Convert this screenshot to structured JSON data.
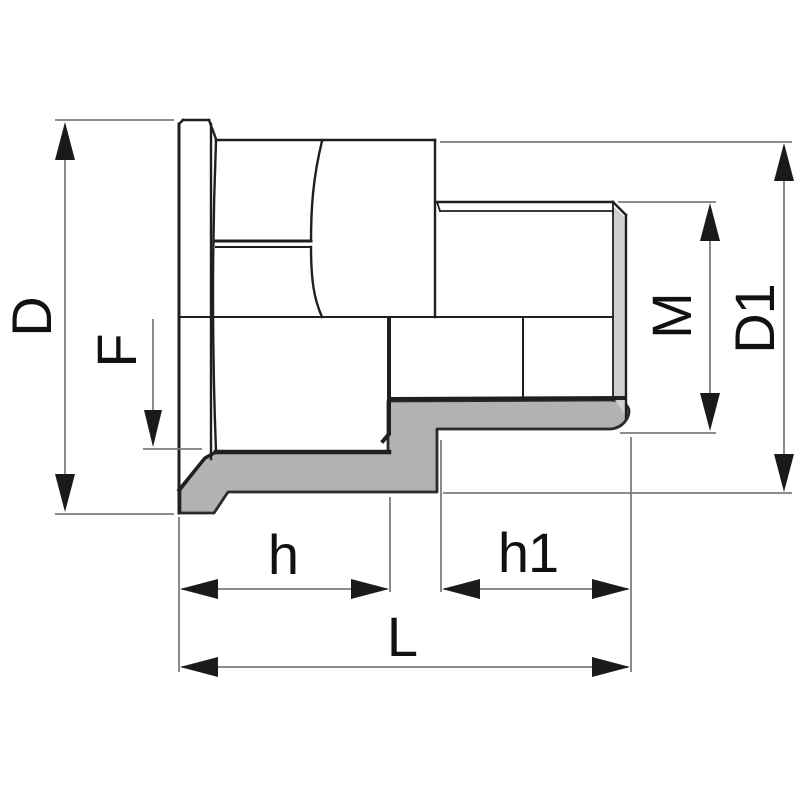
{
  "drawing": {
    "dimension_labels": {
      "D": "D",
      "F": "F",
      "M": "M",
      "D1": "D1",
      "h": "h",
      "h1": "h1",
      "L": "L"
    },
    "colors": {
      "background": "#ffffff",
      "section_fill": "#b2b2b2",
      "thread_end_fill": "#cfcfcf",
      "part_outline": "#1f1f1f",
      "section_edge": "#262626",
      "dimension_line": "#7d7d7d",
      "arrow": "#1a1a1a",
      "label_text": "#111111"
    }
  }
}
